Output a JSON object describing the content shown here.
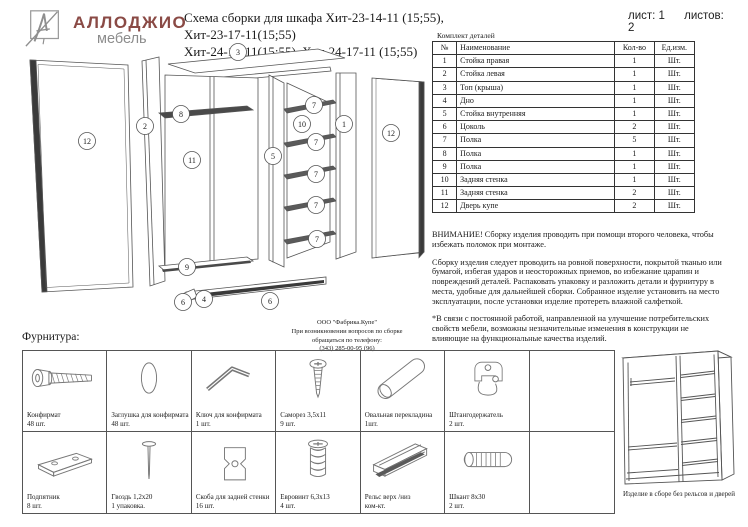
{
  "logo": {
    "brand": "АЛЛОДЖИО",
    "sub": "мебель",
    "brand_color": "#8a4a45",
    "sub_color": "#8c8c8c"
  },
  "title": {
    "line1": "Схема сборки для шкафа Хит-23-14-11 (15;55), Хит-23-17-11(15;55)",
    "line2": "Хит-24-14-11(15;55), Хит-24-17-11 (15;55)"
  },
  "sheet": {
    "sheet_label": "лист: 1",
    "sheets_label": "листов: 2"
  },
  "parts_table": {
    "caption": "Комплект деталей",
    "headers": [
      "№",
      "Наименование",
      "Кол-во",
      "Ед.изм."
    ],
    "rows": [
      [
        "1",
        "Стойка правая",
        "1",
        "Шт."
      ],
      [
        "2",
        "Стойка левая",
        "1",
        "Шт."
      ],
      [
        "3",
        "Топ (крыша)",
        "1",
        "Шт."
      ],
      [
        "4",
        "Дно",
        "1",
        "Шт."
      ],
      [
        "5",
        "Стойка внутренняя",
        "1",
        "Шт."
      ],
      [
        "6",
        "Цоколь",
        "2",
        "Шт."
      ],
      [
        "7",
        "Полка",
        "5",
        "Шт."
      ],
      [
        "8",
        "Полка",
        "1",
        "Шт."
      ],
      [
        "9",
        "Полка",
        "1",
        "Шт."
      ],
      [
        "10",
        "Задняя стенка",
        "1",
        "Шт."
      ],
      [
        "11",
        "Задняя стенка",
        "2",
        "Шт."
      ],
      [
        "12",
        "Дверь купе",
        "2",
        "Шт."
      ]
    ]
  },
  "notices": {
    "warning": "ВНИМАНИЕ! Сборку изделия проводить при помощи второго человека, чтобы избежать поломок при монтаже.",
    "assembly": "Сборку изделия следует проводить на ровной поверхности, покрытой тканью или бумагой, избегая ударов и неосторожных приемов, во избежание царапин и повреждений деталей. Распаковать упаковку и разложить детали и фурнитуру в места, удобные для дальнейшей сборки. Собранное изделие установить на место эксплуатации, после установки изделие протереть влажной салфеткой.",
    "disclaimer": "*В связи с постоянной работой, направленной на улучшение потребительских свойств мебели, возможны незначительные изменения в конструкции не влияющие на функциональные качества изделий."
  },
  "diagram": {
    "callouts": [
      "3",
      "12",
      "2",
      "8",
      "11",
      "9",
      "5",
      "10",
      "7",
      "7",
      "7",
      "7",
      "7",
      "1",
      "12",
      "6",
      "4",
      "6"
    ]
  },
  "factory_note": {
    "line1": "ООО \"Фабрика.Купе\"",
    "line2": "При возникновении вопросов по сборке",
    "line3": "обращаться по телефону:",
    "line4": "(343) 285-00-95 (96)"
  },
  "hardware": {
    "heading": "Фурнитура:",
    "items": [
      {
        "name": "Конфирмат",
        "qty": "48 шт.",
        "icon": "confirmat-screw-icon"
      },
      {
        "name": "Заглушка для конфирмата",
        "qty": "48 шт.",
        "icon": "cap-icon"
      },
      {
        "name": "Ключ для конфирмата",
        "qty": "1 шт.",
        "icon": "hex-key-icon"
      },
      {
        "name": "Саморез 3,5х11",
        "qty": "9 шт.",
        "icon": "screw-icon"
      },
      {
        "name": "Овальная перекладина",
        "qty": "1шт.",
        "icon": "oval-bar-icon"
      },
      {
        "name": "Штангодержатель",
        "qty": "2 шт.",
        "icon": "rod-holder-icon"
      },
      {
        "name": "Подпятник",
        "qty": "8 шт.",
        "icon": "foot-pad-icon"
      },
      {
        "name": "Гвоздь 1,2х20",
        "qty": "1 упаковка.",
        "icon": "nail-icon"
      },
      {
        "name": "Скоба для задней стенки",
        "qty": "16 шт.",
        "icon": "bracket-icon"
      },
      {
        "name": "Евровинт 6,3х13",
        "qty": "4 шт.",
        "icon": "euro-screw-icon"
      },
      {
        "name": "Рельс верх /низ",
        "qty": "ком-кт.",
        "icon": "rail-icon"
      },
      {
        "name": "Шкант 8х30",
        "qty": "2 шт.",
        "icon": "dowel-icon"
      }
    ]
  },
  "assembled": {
    "caption": "Изделие в сборе без рельсов и дверей"
  }
}
